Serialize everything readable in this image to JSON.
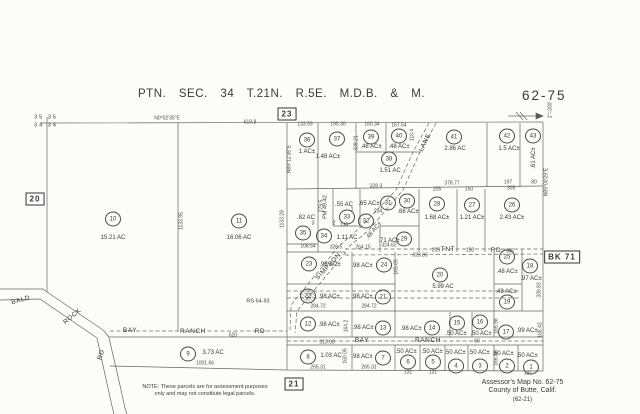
{
  "title": "PTN.  SEC.  34  T.21N.  R.5E.  M.D.B.  &  M.",
  "map_number": "62-75",
  "credits": {
    "line1": "Assessor's  Map  No.   62-75",
    "line2": "County  of  Butte,  Calif.",
    "line3": "(62-21)"
  },
  "note": {
    "line1": "NOTE: These parcels are for assessment purposes",
    "line2": "only and may not constitute legal parcels."
  },
  "boxed_refs": [
    {
      "t": "23",
      "x": 287,
      "y": 114
    },
    {
      "t": "20",
      "x": 35,
      "y": 199
    },
    {
      "t": "21",
      "x": 294,
      "y": 384
    },
    {
      "t": "BK 71",
      "x": 562,
      "y": 257
    }
  ],
  "section_labels": [
    {
      "t": "35 35",
      "x": 46,
      "y": 118
    },
    {
      "t": "34 34",
      "x": 46,
      "y": 126
    }
  ],
  "scale_labels": [
    {
      "t": "1\"=200'",
      "x": 551,
      "y": 110,
      "r": -90
    }
  ],
  "bearings": [
    {
      "t": "N0°02'35\"E",
      "x": 167,
      "y": 119
    },
    {
      "t": "N89°12'38\"E",
      "x": 290,
      "y": 159,
      "r": -90
    },
    {
      "t": "N89°00'29\"E",
      "x": 547,
      "y": 182,
      "r": -90
    }
  ],
  "references": [
    {
      "t": "RS 64-93",
      "x": 258,
      "y": 302
    },
    {
      "t": "PM 49-42",
      "x": 326,
      "y": 207,
      "r": -90
    }
  ],
  "roads": [
    {
      "t": "BALD",
      "x": 21,
      "y": 301,
      "r": -15
    },
    {
      "t": "ROCK",
      "x": 73,
      "y": 317,
      "r": -40
    },
    {
      "t": "RD",
      "x": 102,
      "y": 355,
      "r": -72
    },
    {
      "t": "BAY",
      "x": 130,
      "y": 331
    },
    {
      "t": "RANCH",
      "x": 193,
      "y": 332
    },
    {
      "t": "RD",
      "x": 260,
      "y": 332
    },
    {
      "t": "TNT",
      "x": 448,
      "y": 250
    },
    {
      "t": "RD",
      "x": 496,
      "y": 251
    },
    {
      "t": "BAY",
      "x": 362,
      "y": 341
    },
    {
      "t": "RANCH",
      "x": 428,
      "y": 341
    },
    {
      "t": "LANE",
      "x": 426,
      "y": 143,
      "r": -64
    },
    {
      "t": "SIMPSON",
      "x": 329,
      "y": 267,
      "r": -47
    }
  ],
  "lot_numbers": [
    {
      "t": "1",
      "x": 352,
      "y": 210
    },
    {
      "t": "2",
      "x": 334,
      "y": 224
    },
    {
      "t": "3",
      "x": 313,
      "y": 224
    }
  ],
  "measurements": [
    {
      "t": "619.8",
      "x": 250,
      "y": 123
    },
    {
      "t": "133.59",
      "x": 305,
      "y": 125
    },
    {
      "t": "195.30",
      "x": 338,
      "y": 125
    },
    {
      "t": "160.34",
      "x": 372,
      "y": 125
    },
    {
      "t": "167.54",
      "x": 399,
      "y": 126
    },
    {
      "t": "110.4",
      "x": 413,
      "y": 135,
      "r": -90
    },
    {
      "t": "328.21",
      "x": 357,
      "y": 143,
      "r": -90
    },
    {
      "t": "328.3",
      "x": 376,
      "y": 187
    },
    {
      "t": "378.77",
      "x": 452,
      "y": 184
    },
    {
      "t": "197",
      "x": 508,
      "y": 183
    },
    {
      "t": "80",
      "x": 534,
      "y": 183
    },
    {
      "t": "205",
      "x": 437,
      "y": 190
    },
    {
      "t": "150",
      "x": 469,
      "y": 190
    },
    {
      "t": "305",
      "x": 511,
      "y": 189
    },
    {
      "t": "108.54",
      "x": 308,
      "y": 247
    },
    {
      "t": "328.5",
      "x": 336,
      "y": 248
    },
    {
      "t": "130",
      "x": 344,
      "y": 226
    },
    {
      "t": "204",
      "x": 378,
      "y": 212
    },
    {
      "t": "279.5",
      "x": 322,
      "y": 206,
      "r": -90
    },
    {
      "t": "264.15",
      "x": 363,
      "y": 248
    },
    {
      "t": "324.62",
      "x": 389,
      "y": 246
    },
    {
      "t": "323.83",
      "x": 420,
      "y": 256
    },
    {
      "t": "205",
      "x": 436,
      "y": 251
    },
    {
      "t": "150",
      "x": 470,
      "y": 251
    },
    {
      "t": "305",
      "x": 510,
      "y": 252
    },
    {
      "t": "284.72",
      "x": 318,
      "y": 307
    },
    {
      "t": "284.72",
      "x": 369,
      "y": 307
    },
    {
      "t": "620",
      "x": 233,
      "y": 336
    },
    {
      "t": "313.98",
      "x": 327,
      "y": 343
    },
    {
      "t": "60",
      "x": 477,
      "y": 342
    },
    {
      "t": "1001.66",
      "x": 205,
      "y": 364
    },
    {
      "t": "265.31",
      "x": 318,
      "y": 368
    },
    {
      "t": "265.31",
      "x": 369,
      "y": 368
    },
    {
      "t": "131",
      "x": 408,
      "y": 373
    },
    {
      "t": "131",
      "x": 433,
      "y": 373
    },
    {
      "t": "131",
      "x": 528,
      "y": 374
    },
    {
      "t": "1133.95",
      "x": 182,
      "y": 221,
      "r": -90
    },
    {
      "t": "1133.28",
      "x": 283,
      "y": 219,
      "r": -90
    },
    {
      "t": "165.65",
      "x": 397,
      "y": 267,
      "r": -90
    },
    {
      "t": "164.2",
      "x": 347,
      "y": 326,
      "r": -90
    },
    {
      "t": "160.05",
      "x": 346,
      "y": 356,
      "r": -90
    },
    {
      "t": "165.98",
      "x": 497,
      "y": 326,
      "r": -90
    },
    {
      "t": "166.05",
      "x": 497,
      "y": 358,
      "r": -90
    },
    {
      "t": "330.83",
      "x": 540,
      "y": 290,
      "r": -90
    },
    {
      "t": "166.43",
      "x": 541,
      "y": 330,
      "r": -90
    }
  ],
  "parcels": [
    {
      "n": "1",
      "area": ".50 AC±",
      "c": [
        531,
        367
      ],
      "a": [
        527,
        356
      ]
    },
    {
      "n": "2",
      "area": ".50 AC±",
      "c": [
        507,
        366
      ],
      "a": [
        503,
        354
      ]
    },
    {
      "n": "3",
      "area": ".50 AC±",
      "c": [
        480,
        366
      ],
      "a": [
        479,
        353
      ]
    },
    {
      "n": "4",
      "area": ".50 AC±",
      "c": [
        456,
        366
      ],
      "a": [
        455,
        353
      ]
    },
    {
      "n": "5",
      "area": ".50 AC±",
      "c": [
        433,
        362
      ],
      "a": [
        432,
        352
      ]
    },
    {
      "n": "6",
      "area": ".50 AC±",
      "c": [
        408,
        362
      ],
      "a": [
        406,
        352
      ]
    },
    {
      "n": "7",
      "area": ".98 AC±",
      "c": [
        383,
        358
      ],
      "a": [
        362,
        357
      ]
    },
    {
      "n": "8",
      "area": "1.03 AC",
      "c": [
        308,
        357
      ],
      "a": [
        331,
        356
      ]
    },
    {
      "n": "9",
      "area": "3.73 AC",
      "c": [
        188,
        354
      ],
      "a": [
        213,
        353
      ]
    },
    {
      "n": "10",
      "area": "15.21 AC",
      "c": [
        113,
        219
      ],
      "a": [
        113,
        238
      ]
    },
    {
      "n": "11",
      "area": "16.06 AC",
      "c": [
        239,
        221
      ],
      "a": [
        239,
        238
      ]
    },
    {
      "n": "12",
      "area": ".98 AC±",
      "c": [
        308,
        324
      ],
      "a": [
        329,
        325
      ]
    },
    {
      "n": "13",
      "area": ".98 AC±",
      "c": [
        383,
        328
      ],
      "a": [
        363,
        328
      ]
    },
    {
      "n": "14",
      "area": ".98 AC±",
      "c": [
        432,
        328
      ],
      "a": [
        411,
        329
      ]
    },
    {
      "n": "15",
      "area": ".50 AC±",
      "c": [
        457,
        323
      ],
      "a": [
        456,
        334
      ]
    },
    {
      "n": "16",
      "area": ".50 AC±",
      "c": [
        480,
        322
      ],
      "a": [
        481,
        334
      ]
    },
    {
      "n": "17",
      "area": ".99 AC±",
      "c": [
        506,
        332
      ],
      "a": [
        527,
        331
      ]
    },
    {
      "n": "18",
      "area": ".97 AC±",
      "c": [
        530,
        266
      ],
      "a": [
        531,
        279
      ]
    },
    {
      "n": "19",
      "area": ".48 AC±",
      "c": [
        507,
        302
      ],
      "a": [
        506,
        292
      ]
    },
    {
      "n": "20",
      "area": "5.99 AC",
      "c": [
        440,
        275
      ],
      "a": [
        443,
        287
      ]
    },
    {
      "n": "21",
      "area": ".98 AC±",
      "c": [
        383,
        297
      ],
      "a": [
        362,
        297
      ]
    },
    {
      "n": "22",
      "area": ".98 AC±",
      "c": [
        308,
        296
      ],
      "a": [
        329,
        297
      ],
      "struck": true
    },
    {
      "n": "23",
      "area": ".98 AC±",
      "c": [
        309,
        264
      ],
      "a": [
        330,
        265
      ]
    },
    {
      "n": "24",
      "area": ".98 AC±",
      "c": [
        384,
        265
      ],
      "a": [
        362,
        266
      ]
    },
    {
      "n": "25",
      "area": ".48 AC±",
      "c": [
        507,
        257
      ],
      "a": [
        507,
        272
      ]
    },
    {
      "n": "26",
      "area": "2.43 AC±",
      "c": [
        512,
        205
      ],
      "a": [
        512,
        218
      ]
    },
    {
      "n": "27",
      "area": "1.21 AC±",
      "c": [
        472,
        205
      ],
      "a": [
        472,
        218
      ]
    },
    {
      "n": "28",
      "area": "1.68 AC±",
      "c": [
        437,
        204
      ],
      "a": [
        437,
        218
      ]
    },
    {
      "n": "29",
      "area": ".71 AC±",
      "c": [
        404,
        239
      ],
      "a": [
        389,
        241
      ]
    },
    {
      "n": "30",
      "area": ".68 AC±",
      "c": [
        407,
        201
      ],
      "a": [
        408,
        212
      ]
    },
    {
      "n": "31",
      "area": ".65 AC±",
      "c": [
        388,
        203
      ],
      "a": [
        369,
        204
      ]
    },
    {
      "n": "32",
      "area": ".48 AC±",
      "c": [
        366,
        221
      ],
      "a": [
        374,
        231
      ],
      "ar": -50
    },
    {
      "n": "33",
      "area": ".55 AC",
      "c": [
        347,
        217
      ],
      "a": [
        344,
        205
      ]
    },
    {
      "n": "34",
      "area": "1.11 AC",
      "c": [
        324,
        236
      ],
      "a": [
        347,
        238
      ]
    },
    {
      "n": "35",
      "area": ".82 AC",
      "c": [
        303,
        233
      ],
      "a": [
        306,
        218
      ]
    },
    {
      "n": "36",
      "area": "1 AC±",
      "c": [
        307,
        140
      ],
      "a": [
        307,
        152
      ]
    },
    {
      "n": "37",
      "area": "1.48 AC±",
      "c": [
        337,
        139
      ],
      "a": [
        328,
        157
      ]
    },
    {
      "n": "38",
      "area": "1.51 AC",
      "c": [
        389,
        159
      ],
      "a": [
        390,
        171
      ]
    },
    {
      "n": "39",
      "area": ".48 AC±",
      "c": [
        371,
        137
      ],
      "a": [
        371,
        147
      ]
    },
    {
      "n": "40",
      "area": ".48 AC±",
      "c": [
        399,
        136
      ],
      "a": [
        399,
        147
      ]
    },
    {
      "n": "41",
      "area": "2.86 AC",
      "c": [
        454,
        137
      ],
      "a": [
        455,
        149
      ]
    },
    {
      "n": "42",
      "area": "1.5 AC±",
      "c": [
        507,
        136
      ],
      "a": [
        509,
        149
      ]
    },
    {
      "n": "43",
      "area": ".61 AC±",
      "c": [
        533,
        136
      ],
      "a": [
        534,
        158
      ],
      "ar": -90
    }
  ]
}
